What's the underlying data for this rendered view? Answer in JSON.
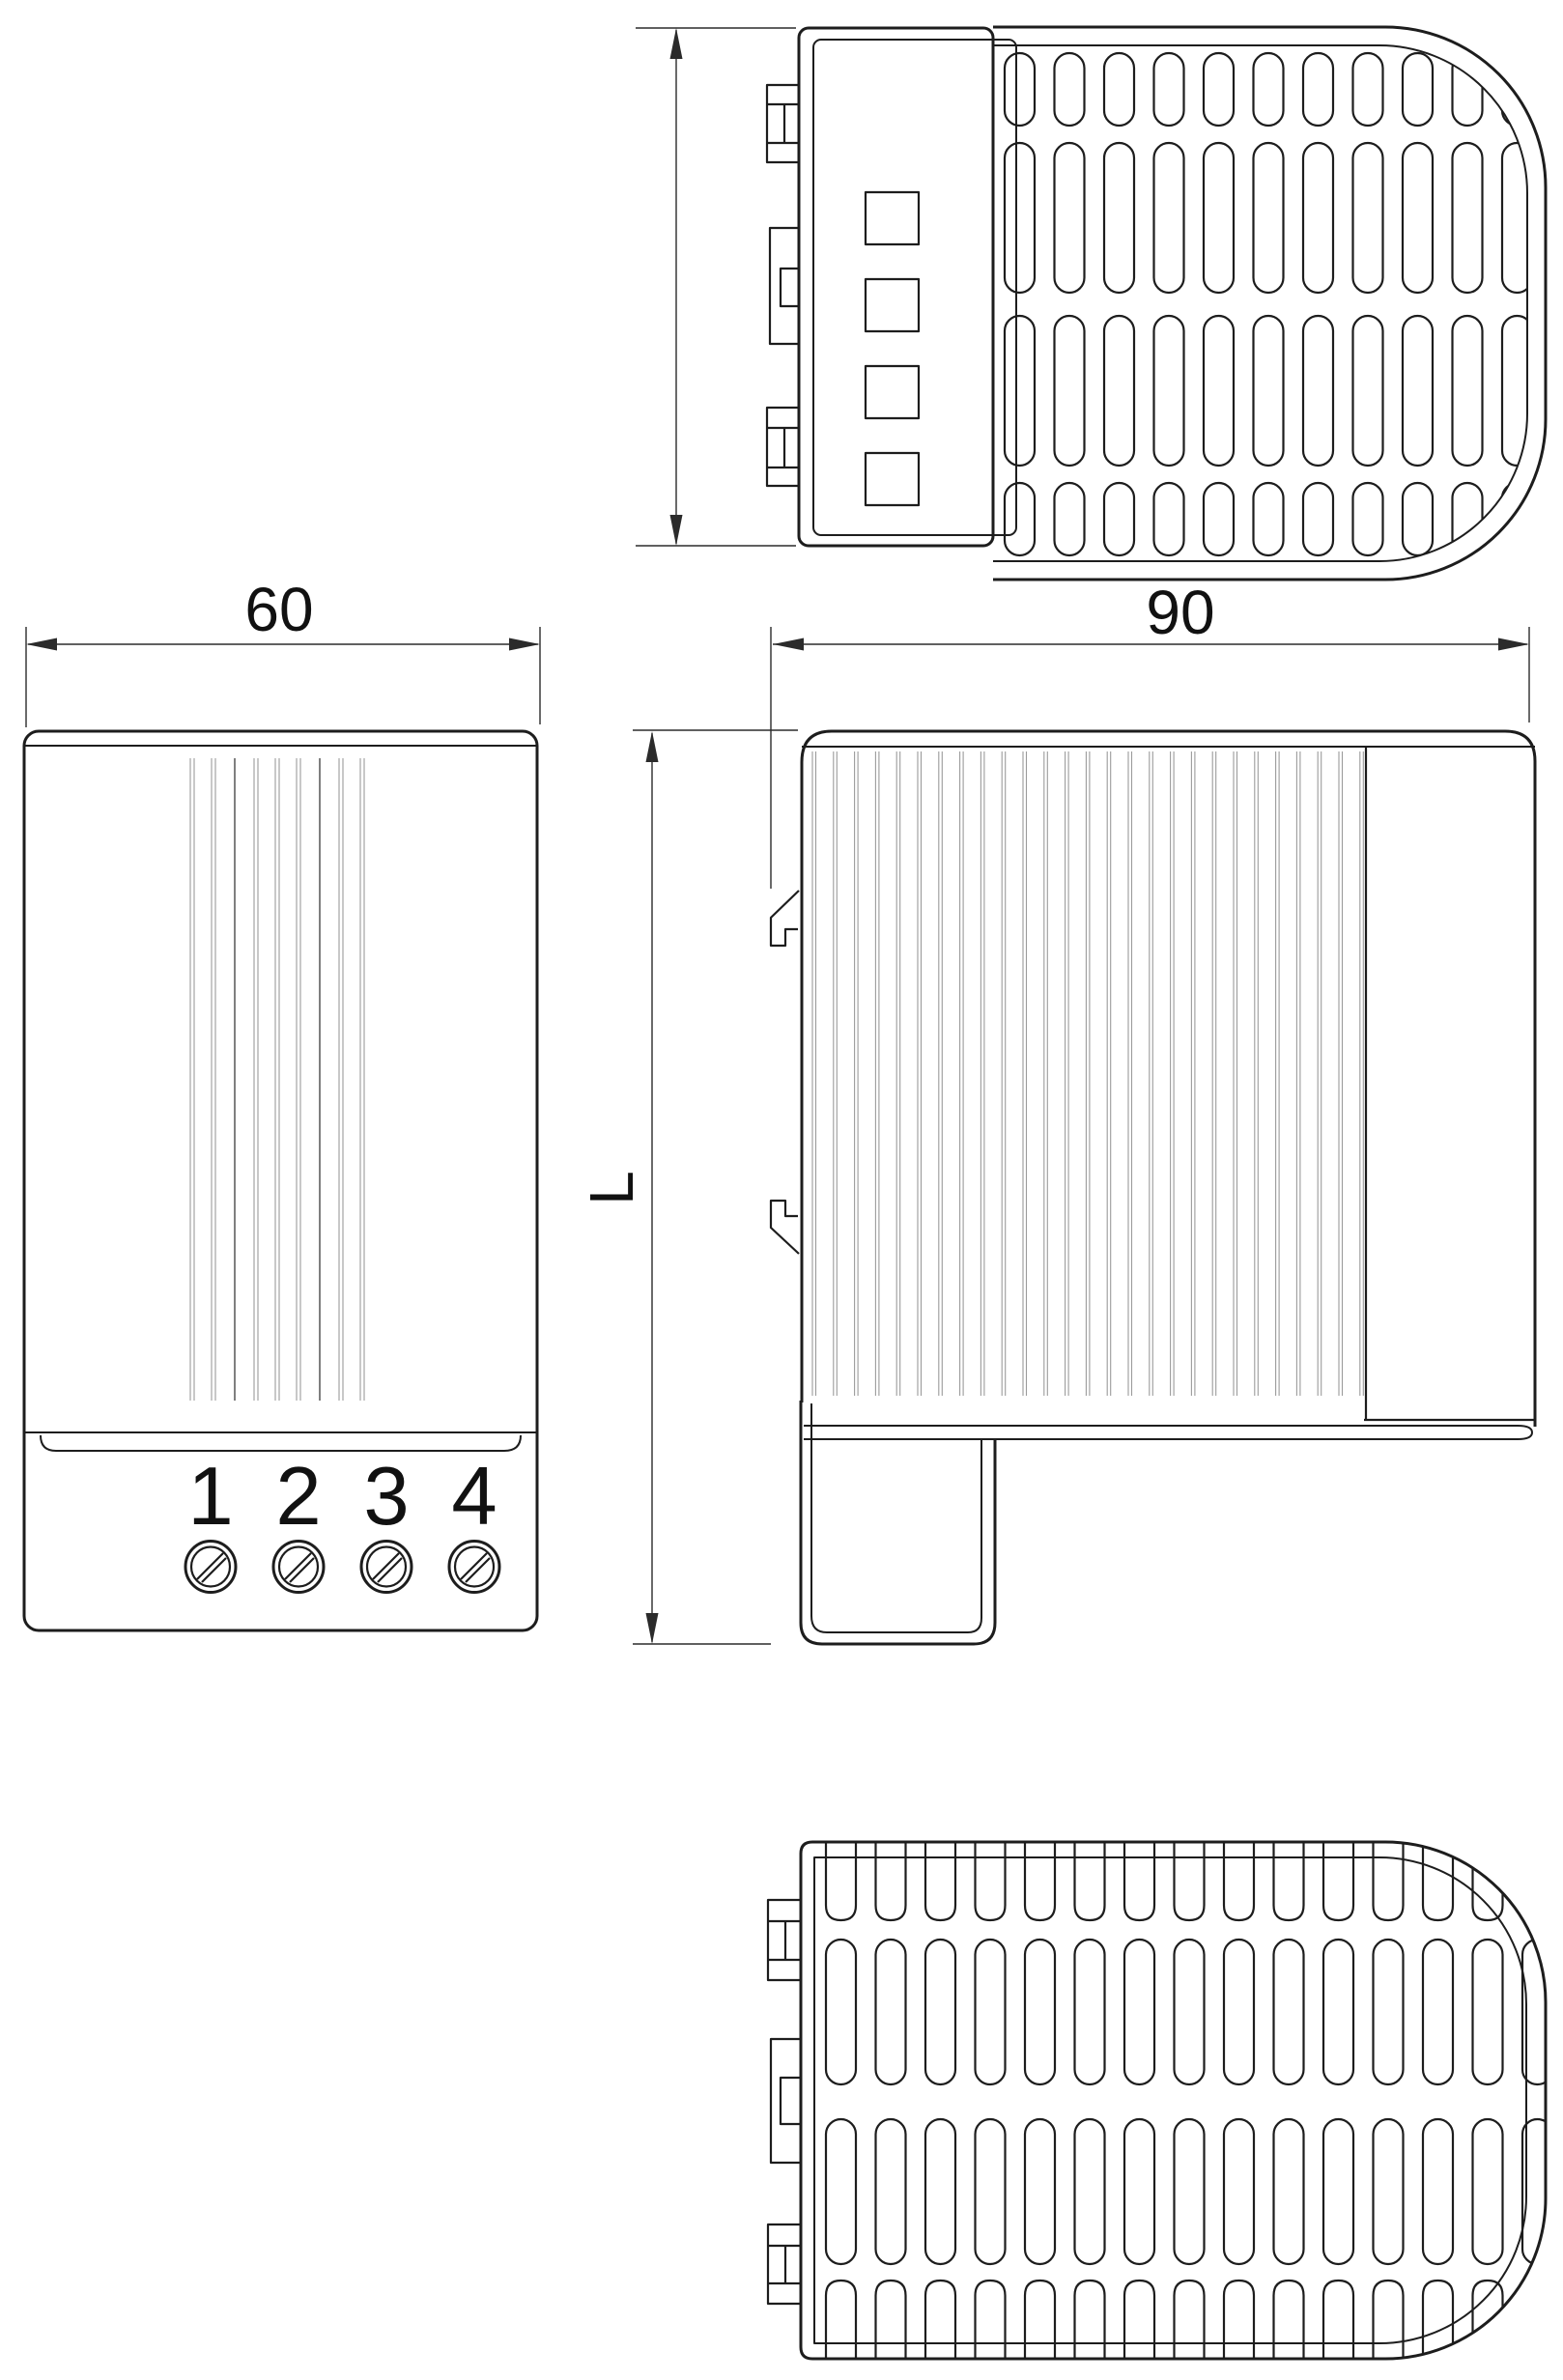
{
  "colors": {
    "background": "#ffffff",
    "outline": "#1d1d1d",
    "fin_line": "#9b9b9b",
    "fin_line_dark": "#555555",
    "dimension_line": "#2b2b2b",
    "text": "#111111"
  },
  "dimensions": {
    "front_width": "60",
    "side_width": "90",
    "side_height_label": "L"
  },
  "terminals": [
    "1",
    "2",
    "3",
    "4"
  ]
}
